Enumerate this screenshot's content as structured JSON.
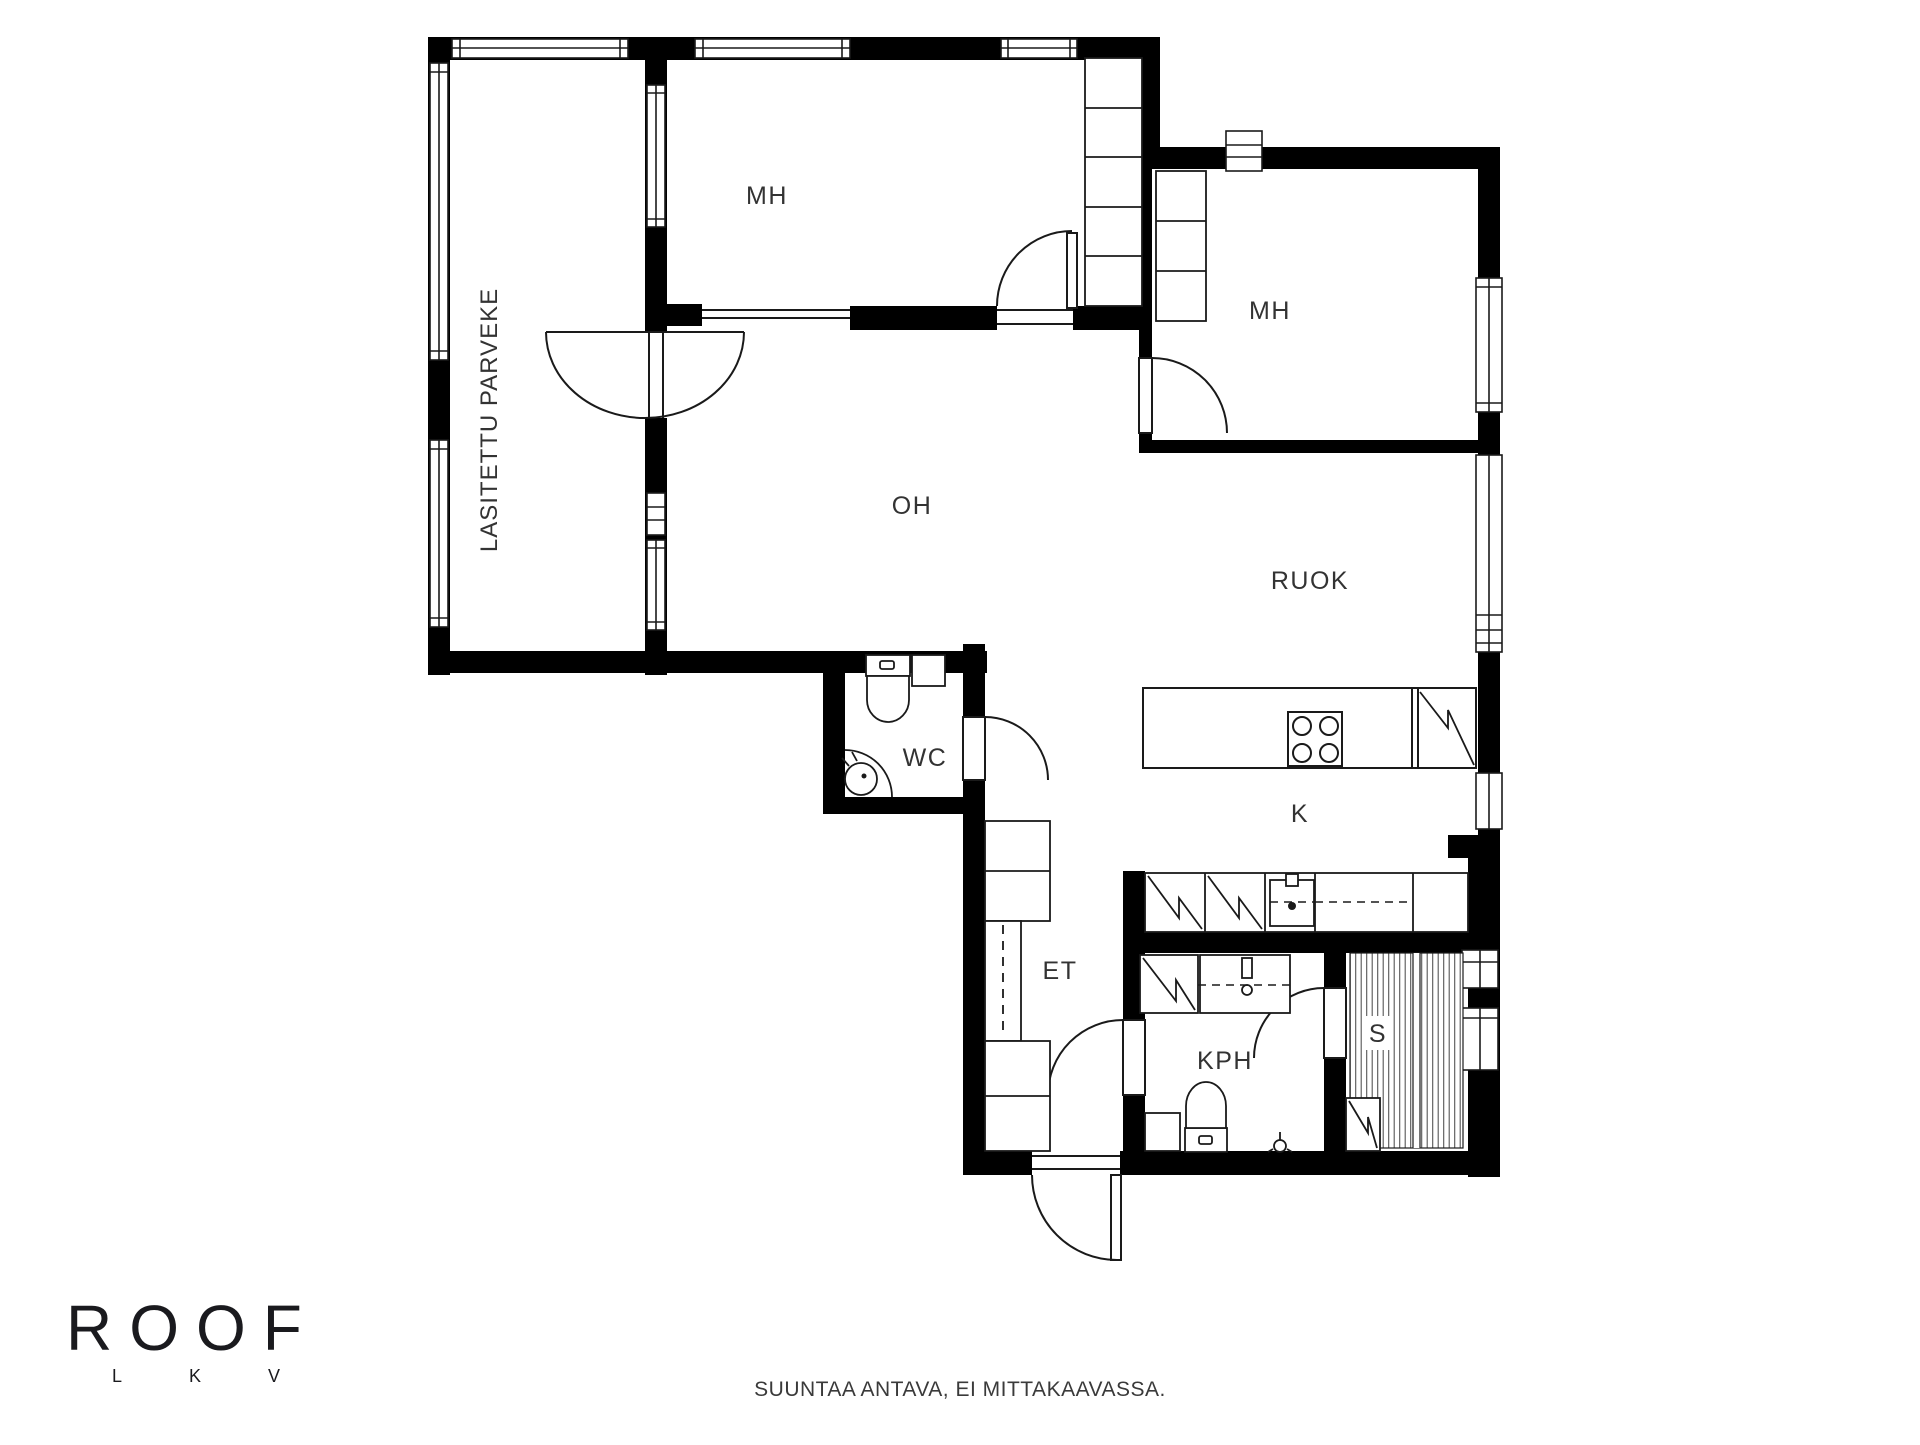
{
  "title": "Floor plan",
  "rooms": {
    "balcony": "LASITETTU PARVEKE",
    "mh1": "MH",
    "mh2": "MH",
    "oh": "OH",
    "ruok": "RUOK",
    "k": "K",
    "wc": "WC",
    "et": "ET",
    "kph": "KPH",
    "s": "S"
  },
  "fixtures": {
    "kitchen": [
      "stove-icon",
      "fridge-icon",
      "counter",
      "washer-icon",
      "washer-icon",
      "kitchen-sink-icon"
    ],
    "wc": [
      "toilet-icon",
      "corner-sink-icon",
      "cabinet"
    ],
    "kph": [
      "shower-icon",
      "sink-icon",
      "toilet-icon",
      "floor-drain-icon",
      "bench"
    ],
    "sauna": [
      "sauna-benches",
      "sauna-heater-icon"
    ],
    "et": [
      "closets",
      "wardrobe-rod"
    ]
  },
  "footer": {
    "disclaimer": "SUUNTAA ANTAVA, EI MITTAKAAVASSA."
  },
  "logo": {
    "brand": "ROOF",
    "sub_letters": [
      "L",
      "K",
      "V"
    ]
  },
  "colors": {
    "background": "#ffffff",
    "wall": "#000000",
    "line": "#1a1a1a",
    "label": "#333333"
  }
}
